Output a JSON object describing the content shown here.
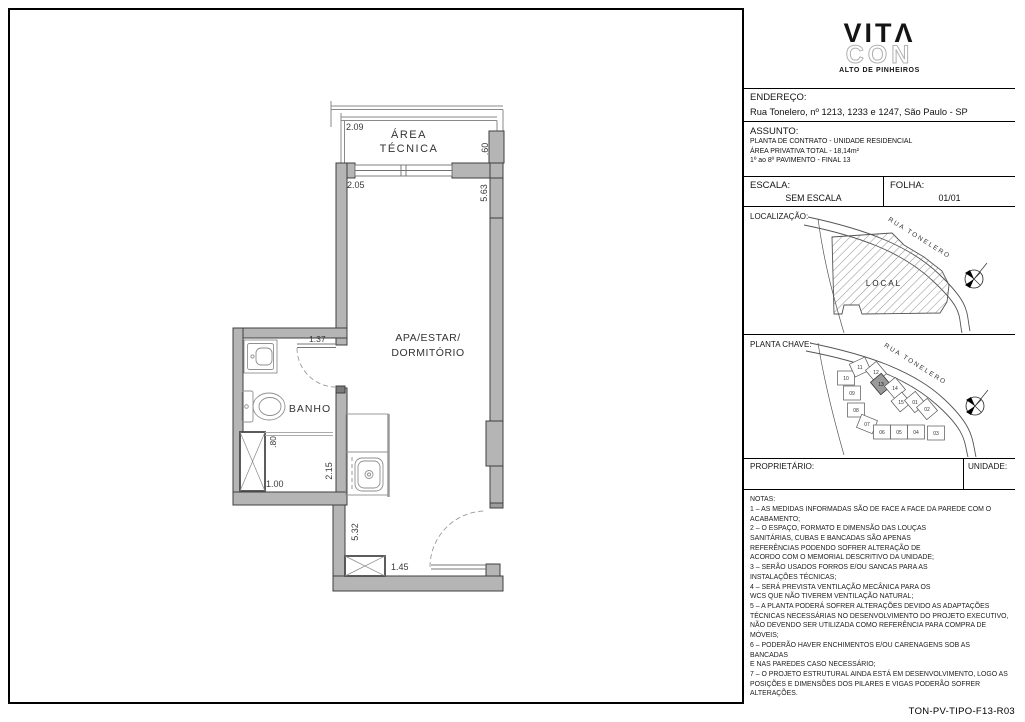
{
  "sheet": {
    "code": "TON-PV-TIPO-F13-R03"
  },
  "logo": {
    "line1": "VITΛ",
    "line2": "CON",
    "tagline": "ALTO DE PINHEIROS"
  },
  "colors": {
    "wall_fill": "#b5b5b5",
    "wall_stroke": "#3f3f3f",
    "fixture_line": "#8f8f8f",
    "highlight_unit": "#9a9a9a"
  },
  "title_block": {
    "endereco": {
      "label": "ENDEREÇO:",
      "value": "Rua Tonelero, nº 1213, 1233 e 1247, São Paulo - SP"
    },
    "assunto": {
      "label": "ASSUNTO:",
      "lines": [
        "PLANTA DE CONTRATO - UNIDADE RESIDENCIAL",
        "ÁREA PRIVATIVA TOTAL - 18,14m²",
        "1º ao 8º PAVIMENTO - FINAL 13"
      ]
    },
    "escala": {
      "label": "ESCALA:",
      "value": "SEM ESCALA"
    },
    "folha": {
      "label": "FOLHA:",
      "value": "01/01"
    },
    "localizacao": {
      "label": "LOCALIZAÇÃO:",
      "area_label": "LOCAL",
      "street": "RUA TONELERO"
    },
    "planta_chave": {
      "label": "PLANTA CHAVE:",
      "street": "RUA TONELERO",
      "highlighted_unit": "13",
      "units": [
        "01",
        "02",
        "03",
        "04",
        "05",
        "06",
        "07",
        "08",
        "09",
        "10",
        "11",
        "12",
        "13",
        "14",
        "15"
      ]
    },
    "proprietario": {
      "label": "PROPRIETÁRIO:"
    },
    "unidade": {
      "label": "UNIDADE:"
    }
  },
  "plan": {
    "rooms": {
      "area_tecnica_1": "ÁREA",
      "area_tecnica_2": "TÉCNICA",
      "living_1": "APA/ESTAR/",
      "living_2": "DORMITÓRIO",
      "bath": "BANHO"
    },
    "dimensions": {
      "top_setback": "2.09",
      "room_width": "2.05",
      "right_depth": ".60",
      "room_length": "5.63",
      "bath_door": "1.37",
      "shower_width": ".80",
      "bath_width": "1.00",
      "bath_length": "2.15",
      "corridor_length": "5.32",
      "entry_width": "1.45"
    }
  },
  "notes": {
    "label": "NOTAS:",
    "lines": [
      "1 – AS MEDIDAS INFORMADAS SÃO DE FACE A FACE DA PAREDE COM O",
      "ACABAMENTO;",
      "2 – O ESPAÇO, FORMATO E DIMENSÃO DAS LOUÇAS",
      "SANITÁRIAS, CUBAS E BANCADAS SÃO APENAS",
      "REFERÊNCIAS PODENDO SOFRER ALTERAÇÃO DE",
      "ACORDO COM O MEMORIAL DESCRITIVO DA UNIDADE;",
      "3 – SERÃO USADOS FORROS E/OU SANCAS PARA AS",
      "INSTALAÇÕES TÉCNICAS;",
      "4 – SERÁ PREVISTA VENTILAÇÃO MECÂNICA PARA OS",
      "WCS QUE NÃO TIVEREM VENTILAÇÃO NATURAL;",
      "5 – A PLANTA PODERÁ SOFRER ALTERAÇÕES DEVIDO AS ADAPTAÇÕES",
      "TÉCNICAS NECESSÁRIAS NO DESENVOLVIMENTO DO PROJETO EXECUTIVO,",
      "NÃO DEVENDO SER UTILIZADA COMO REFERÊNCIA PARA COMPRA DE",
      "MÓVEIS;",
      "6 – PODERÃO HAVER ENCHIMENTOS E/OU CARENAGENS SOB AS BANCADAS",
      "E NAS PAREDES CASO NECESSÁRIO;",
      "7 – O PROJETO ESTRUTURAL AINDA ESTÁ EM DESENVOLVIMENTO, LOGO AS",
      "POSIÇÕES E DIMENSÕES DOS PILARES E VIGAS PODERÃO SOFRER",
      "ALTERAÇÕES."
    ]
  }
}
